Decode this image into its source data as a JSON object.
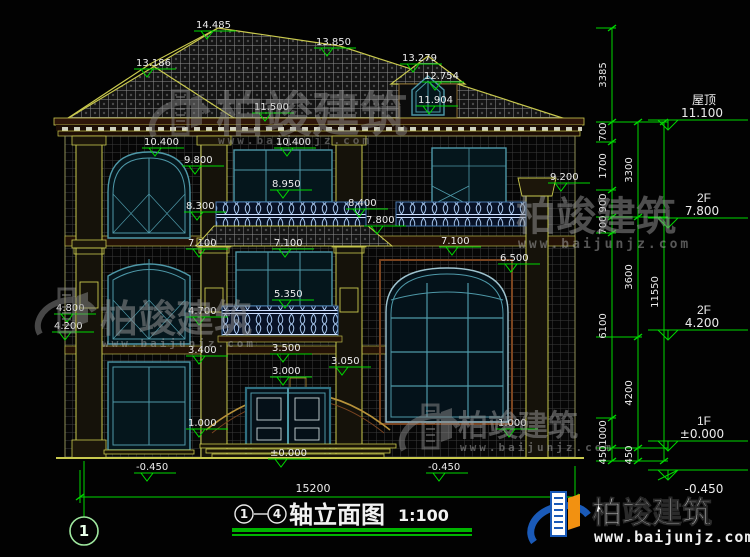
{
  "watermark": {
    "brand": "柏竣建筑",
    "url": "www.baijunjz.com"
  },
  "title": {
    "axis_from": "1",
    "axis_to": "4",
    "name": "轴立面图",
    "scale": "1:100"
  },
  "axis_bubble": "1",
  "dims": {
    "total_width": "15200",
    "total_height": "11550"
  },
  "levels_right": [
    {
      "name": "屋顶",
      "value": "11.100"
    },
    {
      "name": "2F",
      "value": "7.800"
    },
    {
      "name": "2F",
      "value": "4.200"
    },
    {
      "name": "1F",
      "value": "±0.000"
    },
    {
      "name": "",
      "value": "-0.450"
    }
  ],
  "chain1": [
    "3385",
    "700",
    "1700",
    "900",
    "700",
    "6100",
    "1000",
    "450"
  ],
  "chain2": [
    "3300",
    "3600",
    "4200",
    "450"
  ],
  "marks": [
    "14.485",
    "13.850",
    "13.186",
    "13.279",
    "12.754",
    "11.904",
    "11.500",
    "10.400",
    "10.400",
    "9.800",
    "9.200",
    "8.950",
    "8.300",
    "8.400",
    "7.800",
    "7.100",
    "7.100",
    "7.100",
    "6.500",
    "5.350",
    "4.800",
    "4.700",
    "4.200",
    "3.500",
    "3.400",
    "3.050",
    "3.000",
    "1.000",
    "1.000",
    "±0.000",
    "-0.450",
    "-0.450"
  ]
}
